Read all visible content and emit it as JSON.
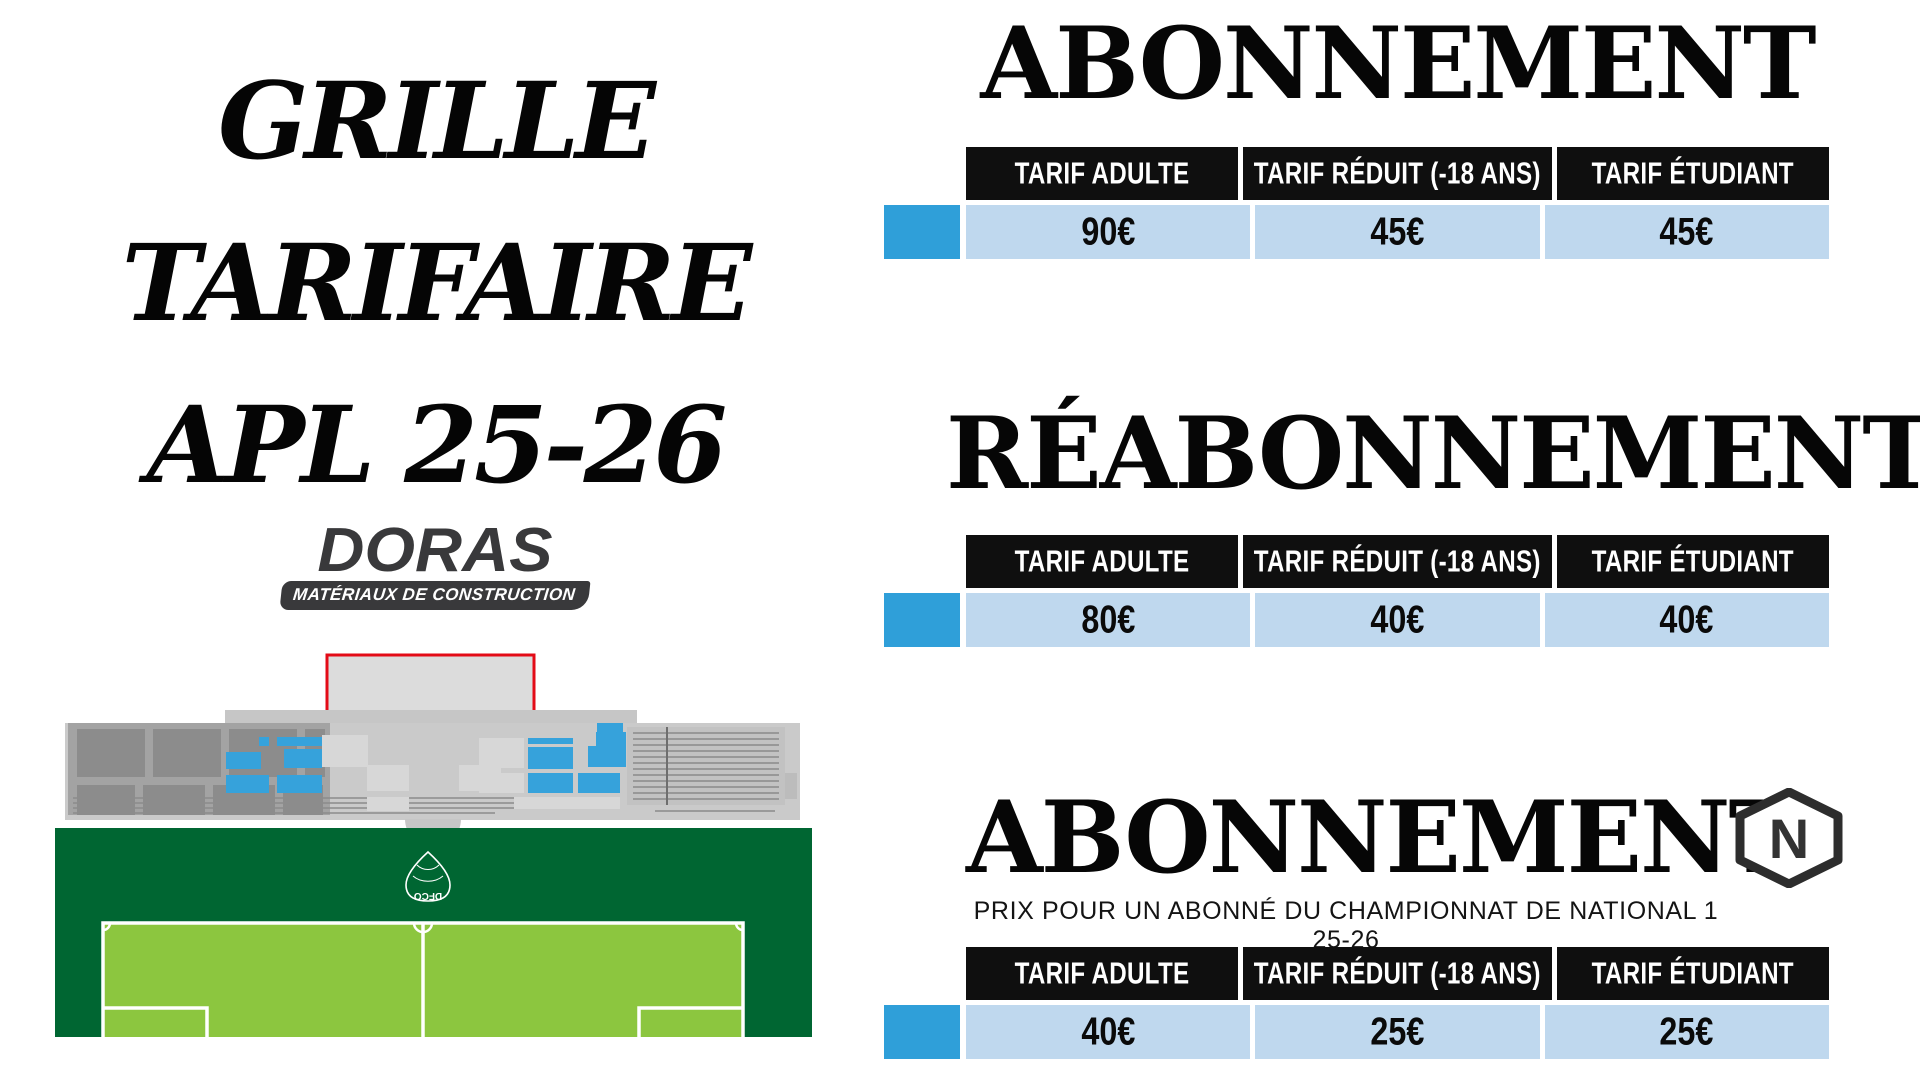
{
  "title": {
    "line1": "GRILLE",
    "line2": "TARIFAIRE",
    "line3": "APL 25-26"
  },
  "sponsor": {
    "name": "DORAS",
    "tagline": "MATÉRIAUX DE CONSTRUCTION"
  },
  "stadium": {
    "club_crest_text": "DFCO",
    "seat_color": "#36a2db",
    "field_dark_green": "#006632",
    "pitch_light_green": "#8cc63f",
    "stand_gray": "#c9c9c9",
    "box_outline_red": "#e30b17"
  },
  "sections": [
    {
      "heading": "ABONNEMENT",
      "headers": [
        "TARIF ADULTE",
        "TARIF RÉDUIT (-18 ANS)",
        "TARIF ÉTUDIANT"
      ],
      "prices": [
        "90€",
        "45€",
        "45€"
      ]
    },
    {
      "heading": "RÉABONNEMENT",
      "headers": [
        "TARIF ADULTE",
        "TARIF RÉDUIT (-18 ANS)",
        "TARIF ÉTUDIANT"
      ],
      "prices": [
        "80€",
        "40€",
        "40€"
      ]
    },
    {
      "heading": "ABONNEMENT",
      "badge": "N",
      "subtitle": "PRIX POUR UN ABONNÉ DU CHAMPIONNAT DE NATIONAL 1 25-26",
      "headers": [
        "TARIF ADULTE",
        "TARIF RÉDUIT (-18 ANS)",
        "TARIF ÉTUDIANT"
      ],
      "prices": [
        "40€",
        "25€",
        "25€"
      ]
    }
  ],
  "colors": {
    "table_header_bg": "#0f0f0f",
    "table_row_bg": "#bfd8ee",
    "legend_swatch": "#2f9fd9",
    "text": "#050505"
  }
}
